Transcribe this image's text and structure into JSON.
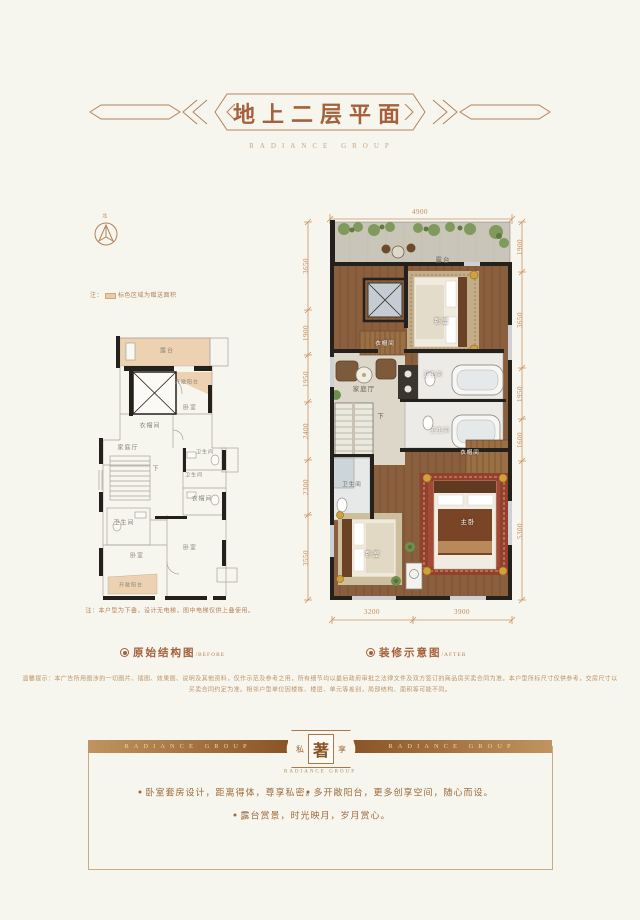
{
  "header": {
    "title": "地上二层平面",
    "brand": "RADIANCE GROUP"
  },
  "compass": {
    "north": "北"
  },
  "legend": {
    "prefix": "注：",
    "text": "标色区域为赠送面积"
  },
  "before": {
    "caption": "原始结构图",
    "caption_en": "/BEFORE",
    "note": "注：本户型为下叠，设计无电梯，图中电梯仅供上叠使用。",
    "labels": [
      "露台",
      "开敞阳台",
      "衣帽间",
      "卧室",
      "家庭厅",
      "卫生间",
      "卫生间",
      "衣帽间",
      "卫生间",
      "卧室",
      "卧室",
      "开敞阳台",
      "下"
    ]
  },
  "after": {
    "caption": "装修示意图",
    "caption_en": "/AFTER",
    "labels": [
      "露台",
      "卧室",
      "衣帽间",
      "家庭厅",
      "卫生间",
      "卫生间",
      "衣帽间",
      "下",
      "卫生间",
      "主卧",
      "卧室"
    ],
    "dims": {
      "top": [
        "4900"
      ],
      "left": [
        "3650",
        "1900",
        "1950",
        "2400",
        "2300",
        "3550"
      ],
      "right": [
        "1900",
        "3650",
        "1950",
        "1600",
        "5300"
      ],
      "bottom": [
        "3200",
        "3900"
      ]
    }
  },
  "disclaimer": {
    "line1": "温馨提示：本广告所用图涉的一切图片、插图、效果图、说明及其他资料，仅作示范及参考之用，所有细节均以最后政府审批之法律文件及双方签订的商品房买卖合同为准。本户型所标尺寸仅供参考，交房尺寸以",
    "line2": "买卖合同约定为准。相邻户型单位因楼栋、楼层、单元等差别，局部结构、面积等可能不同。"
  },
  "footer": {
    "brand": "RADIANCE GROUP",
    "badge": {
      "left": "私",
      "center": "著",
      "right": "享"
    },
    "bullets": [
      "卧室套房设计，距离得体，尊享私密。",
      "多开敞阳台，更多创享空间，随心而设。",
      "露台赏景，时光映月，岁月赏心。"
    ]
  }
}
